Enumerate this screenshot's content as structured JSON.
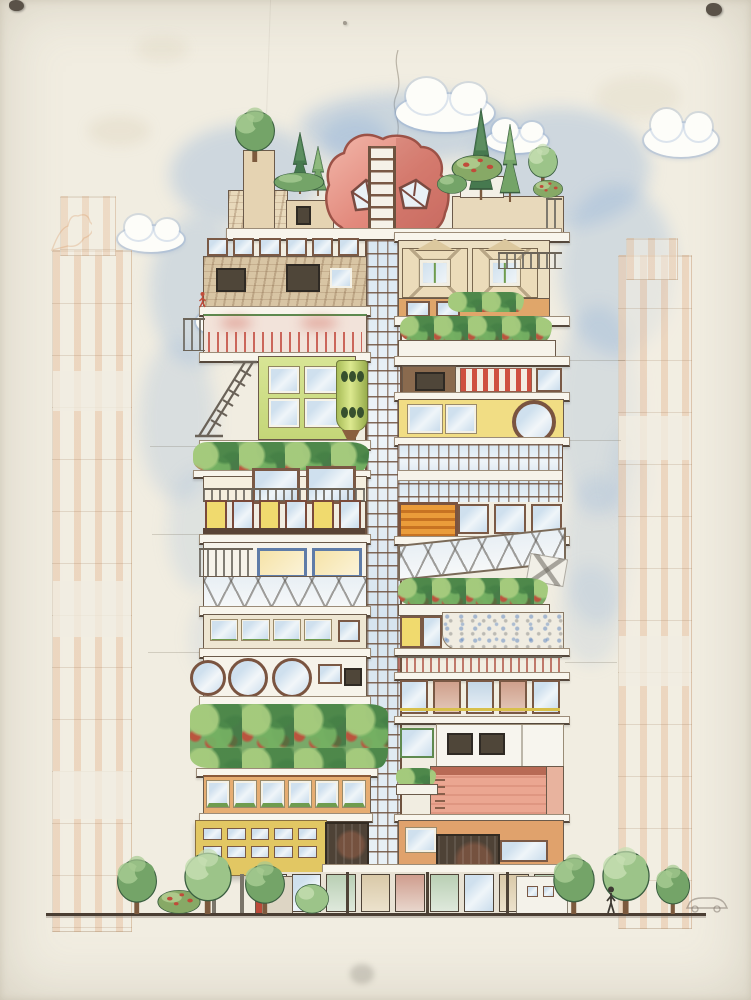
{
  "scene": {
    "description": "Colored-pencil architectural elevation drawing of a tall collage-like tower of stacked, mismatched apartment modules with a rooftop garden, a pink boulder penthouse split by a ladder shaft, a central glazed stair shaft, faint orange sketches of neighbouring towers, blue scribbled sky with clouds, and a street level with trees, a pedestrian and a faint car",
    "palette": {
      "paper": "#f1ede1",
      "paper_edge": "#e3ddcc",
      "sky": "#7da3cf",
      "cloud": "#fdfdf9",
      "ink": "#55483c",
      "frame_brown": "#7a5945",
      "slab": "#f8f5ec",
      "stone": "#d8c5a4",
      "beige": "#ecdcba",
      "lime": "#cede83",
      "yellow": "#f0da6e",
      "orange": "#e2a368",
      "mustard": "#e2c763",
      "red": "#c14b3a",
      "rock_pink": "#e79a8d",
      "salmon": "#eba691",
      "glass_blue": "#cfe0ee",
      "trunk": "#7c5a3e",
      "street_line": "#4a3e33",
      "background_sketch": "#d89a66"
    },
    "foliage_tones": {
      "light": {
        "f": "#9cc489",
        "h": "#c6deb2"
      },
      "mid": {
        "f": "#74a468",
        "h": "#a6cb92"
      },
      "dark": {
        "f": "#46794f",
        "h": "#6fa06f"
      },
      "red": {
        "f": "#87a966",
        "h": "#b6d094"
      }
    },
    "flower_color": "#c14b3a",
    "sky_patches": [
      {
        "x": 300,
        "y": 92,
        "w": 210,
        "h": 70,
        "o": 0.32
      },
      {
        "x": 170,
        "y": 125,
        "w": 150,
        "h": 100,
        "o": 0.3
      },
      {
        "x": 470,
        "y": 108,
        "w": 180,
        "h": 120,
        "o": 0.3
      },
      {
        "x": 320,
        "y": 115,
        "w": 70,
        "h": 55,
        "o": 0.28
      },
      {
        "x": 560,
        "y": 185,
        "w": 115,
        "h": 170,
        "o": 0.26
      },
      {
        "x": 150,
        "y": 215,
        "w": 95,
        "h": 150,
        "o": 0.26
      },
      {
        "x": 140,
        "y": 340,
        "w": 75,
        "h": 160,
        "o": 0.2
      },
      {
        "x": 556,
        "y": 305,
        "w": 85,
        "h": 210,
        "o": 0.22
      },
      {
        "x": 562,
        "y": 475,
        "w": 70,
        "h": 150,
        "o": 0.18
      },
      {
        "x": 168,
        "y": 470,
        "w": 62,
        "h": 120,
        "o": 0.16
      },
      {
        "x": 560,
        "y": 565,
        "w": 62,
        "h": 100,
        "o": 0.15
      },
      {
        "x": 190,
        "y": 598,
        "w": 52,
        "h": 80,
        "o": 0.12
      },
      {
        "x": 610,
        "y": 430,
        "w": 40,
        "h": 90,
        "o": 0.14
      }
    ],
    "clouds": [
      {
        "x": 396,
        "y": 94,
        "w": 98,
        "h": 38
      },
      {
        "x": 486,
        "y": 129,
        "w": 62,
        "h": 24
      },
      {
        "x": 644,
        "y": 123,
        "w": 74,
        "h": 34
      },
      {
        "x": 118,
        "y": 226,
        "w": 66,
        "h": 26
      },
      {
        "x": 196,
        "y": 308,
        "w": 58,
        "h": 28
      }
    ],
    "trees": [
      {
        "kind": "round",
        "x": 228,
        "y": 100,
        "w": 54,
        "h": 62,
        "tone": "mid"
      },
      {
        "kind": "conifer",
        "x": 287,
        "y": 132,
        "w": 26,
        "h": 62,
        "tone": "dark"
      },
      {
        "kind": "conifer",
        "x": 307,
        "y": 146,
        "w": 22,
        "h": 50,
        "tone": "mid"
      },
      {
        "kind": "bush",
        "x": 272,
        "y": 166,
        "w": 54,
        "h": 26,
        "tone": "mid"
      },
      {
        "kind": "conifer",
        "x": 466,
        "y": 108,
        "w": 30,
        "h": 92,
        "tone": "dark"
      },
      {
        "kind": "conifer",
        "x": 497,
        "y": 124,
        "w": 26,
        "h": 78,
        "tone": "mid"
      },
      {
        "kind": "round",
        "x": 523,
        "y": 138,
        "w": 40,
        "h": 48,
        "tone": "light"
      },
      {
        "kind": "bush",
        "x": 450,
        "y": 146,
        "w": 54,
        "h": 36,
        "tone": "red"
      },
      {
        "kind": "bush",
        "x": 532,
        "y": 174,
        "w": 32,
        "h": 24,
        "tone": "red"
      },
      {
        "kind": "bush",
        "x": 436,
        "y": 168,
        "w": 32,
        "h": 26,
        "tone": "mid"
      },
      {
        "kind": "round",
        "x": 110,
        "y": 848,
        "w": 54,
        "h": 66,
        "tone": "mid"
      },
      {
        "kind": "bush",
        "x": 156,
        "y": 882,
        "w": 46,
        "h": 32,
        "tone": "red"
      },
      {
        "kind": "round",
        "x": 176,
        "y": 840,
        "w": 64,
        "h": 74,
        "tone": "light"
      },
      {
        "kind": "round",
        "x": 238,
        "y": 854,
        "w": 54,
        "h": 60,
        "tone": "mid"
      },
      {
        "kind": "bush",
        "x": 294,
        "y": 874,
        "w": 36,
        "h": 40,
        "tone": "light"
      },
      {
        "kind": "round",
        "x": 546,
        "y": 846,
        "w": 56,
        "h": 68,
        "tone": "mid"
      },
      {
        "kind": "round",
        "x": 594,
        "y": 838,
        "w": 64,
        "h": 76,
        "tone": "light"
      },
      {
        "kind": "round",
        "x": 650,
        "y": 858,
        "w": 46,
        "h": 56,
        "tone": "mid"
      }
    ],
    "figures": {
      "pedestrian": {
        "x": 606,
        "y": 886,
        "w": 10,
        "h": 28,
        "color": "#3e3a33"
      },
      "car_sketch": {
        "x": 684,
        "y": 896,
        "w": 44,
        "h": 17,
        "color": "rgba(120,110,100,0.5)"
      },
      "climber": {
        "x": 199,
        "y": 292,
        "w": 7,
        "h": 16,
        "color": "#c14b3a"
      }
    },
    "street_line": {
      "x": 46,
      "y": 913,
      "w": 660,
      "h": 3
    }
  }
}
